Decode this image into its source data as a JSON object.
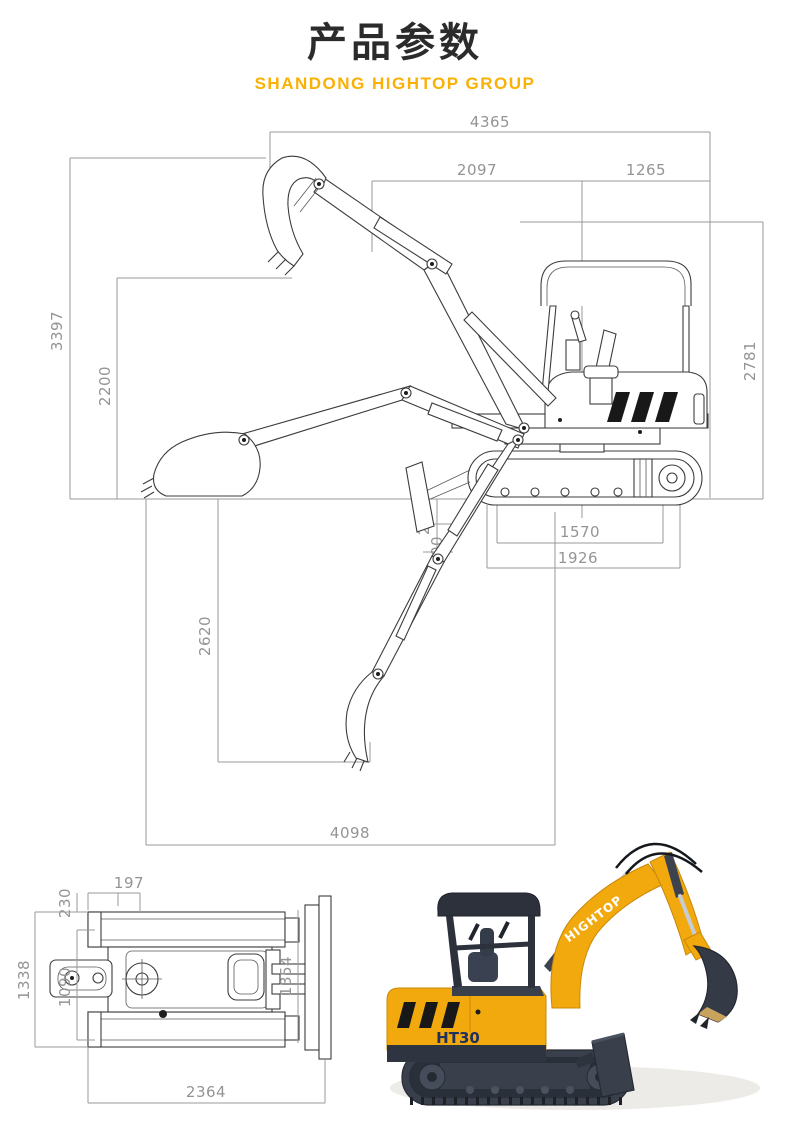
{
  "header": {
    "title": "产品参数",
    "subtitle": "SHANDONG HIGHTOP GROUP"
  },
  "colors": {
    "accent_yellow": "#FBB004",
    "machine_yellow": "#F2A90D",
    "machine_dark": "#39404C",
    "dim_gray": "#9a9a9a",
    "line_dark": "#3c3c3c"
  },
  "side_view": {
    "dims": {
      "overall_length": "4365",
      "front_section_length": "2097",
      "rear_section_length": "1265",
      "max_height": "3397",
      "mid_height": "2200",
      "transport_height": "2781",
      "blade_lift_height": "245",
      "blade_dig_depth": "300",
      "wheelbase": "1570",
      "track_length": "1926",
      "max_dig_depth": "2620",
      "max_dig_reach": "4098"
    }
  },
  "top_view": {
    "dims": {
      "track_shoe_width": "197",
      "track_edge_offset": "230",
      "overall_width": "1338",
      "track_gauge": "1090",
      "blade_width": "1354",
      "transport_length": "2364"
    }
  },
  "photo": {
    "brand": "HIGHTOP",
    "model": "HT30"
  }
}
